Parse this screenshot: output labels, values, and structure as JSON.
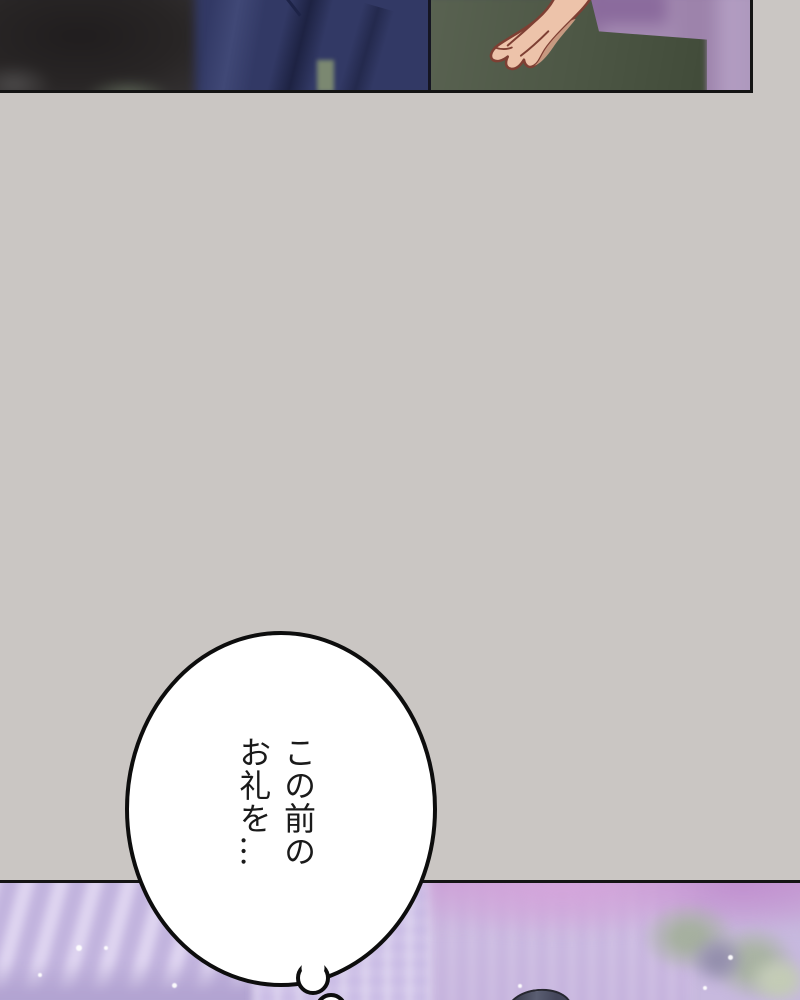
{
  "page": {
    "width_px": 800,
    "height_px": 1000,
    "background_color": "#cac6c3",
    "type_label": "comic-page"
  },
  "top_panel": {
    "content_label": "close-up of navy suit torso with raised hand, blurred alley wall",
    "colors": {
      "suit_navy": "#323965",
      "wall_green": "#4d5745",
      "wall_purple": "#a48bb2",
      "foreground_blur_dark": "#282525",
      "hand_skin": "#edc3aa",
      "hand_outline": "#7e3f33",
      "panel_border": "#141414"
    }
  },
  "bottom_panel": {
    "content_label": "blurred lavender city street, pink sky, trees, top of dark-haired head",
    "colors": {
      "base_lavender": "#c7b9de",
      "building_light": "#ded4f0",
      "sky_pink": "#c99dd4",
      "tree_green": "#a6b0a0",
      "hair_dark": "#44465a",
      "panel_border": "#141414"
    }
  },
  "thought_bubble": {
    "shape": "ellipse-with-tail-circles",
    "fill": "#ffffff",
    "stroke": "#0d0d0d",
    "writing_mode": "vertical-rl",
    "lines": [
      "この前の",
      "お礼を…"
    ],
    "full_text": "この前のお礼を…"
  }
}
